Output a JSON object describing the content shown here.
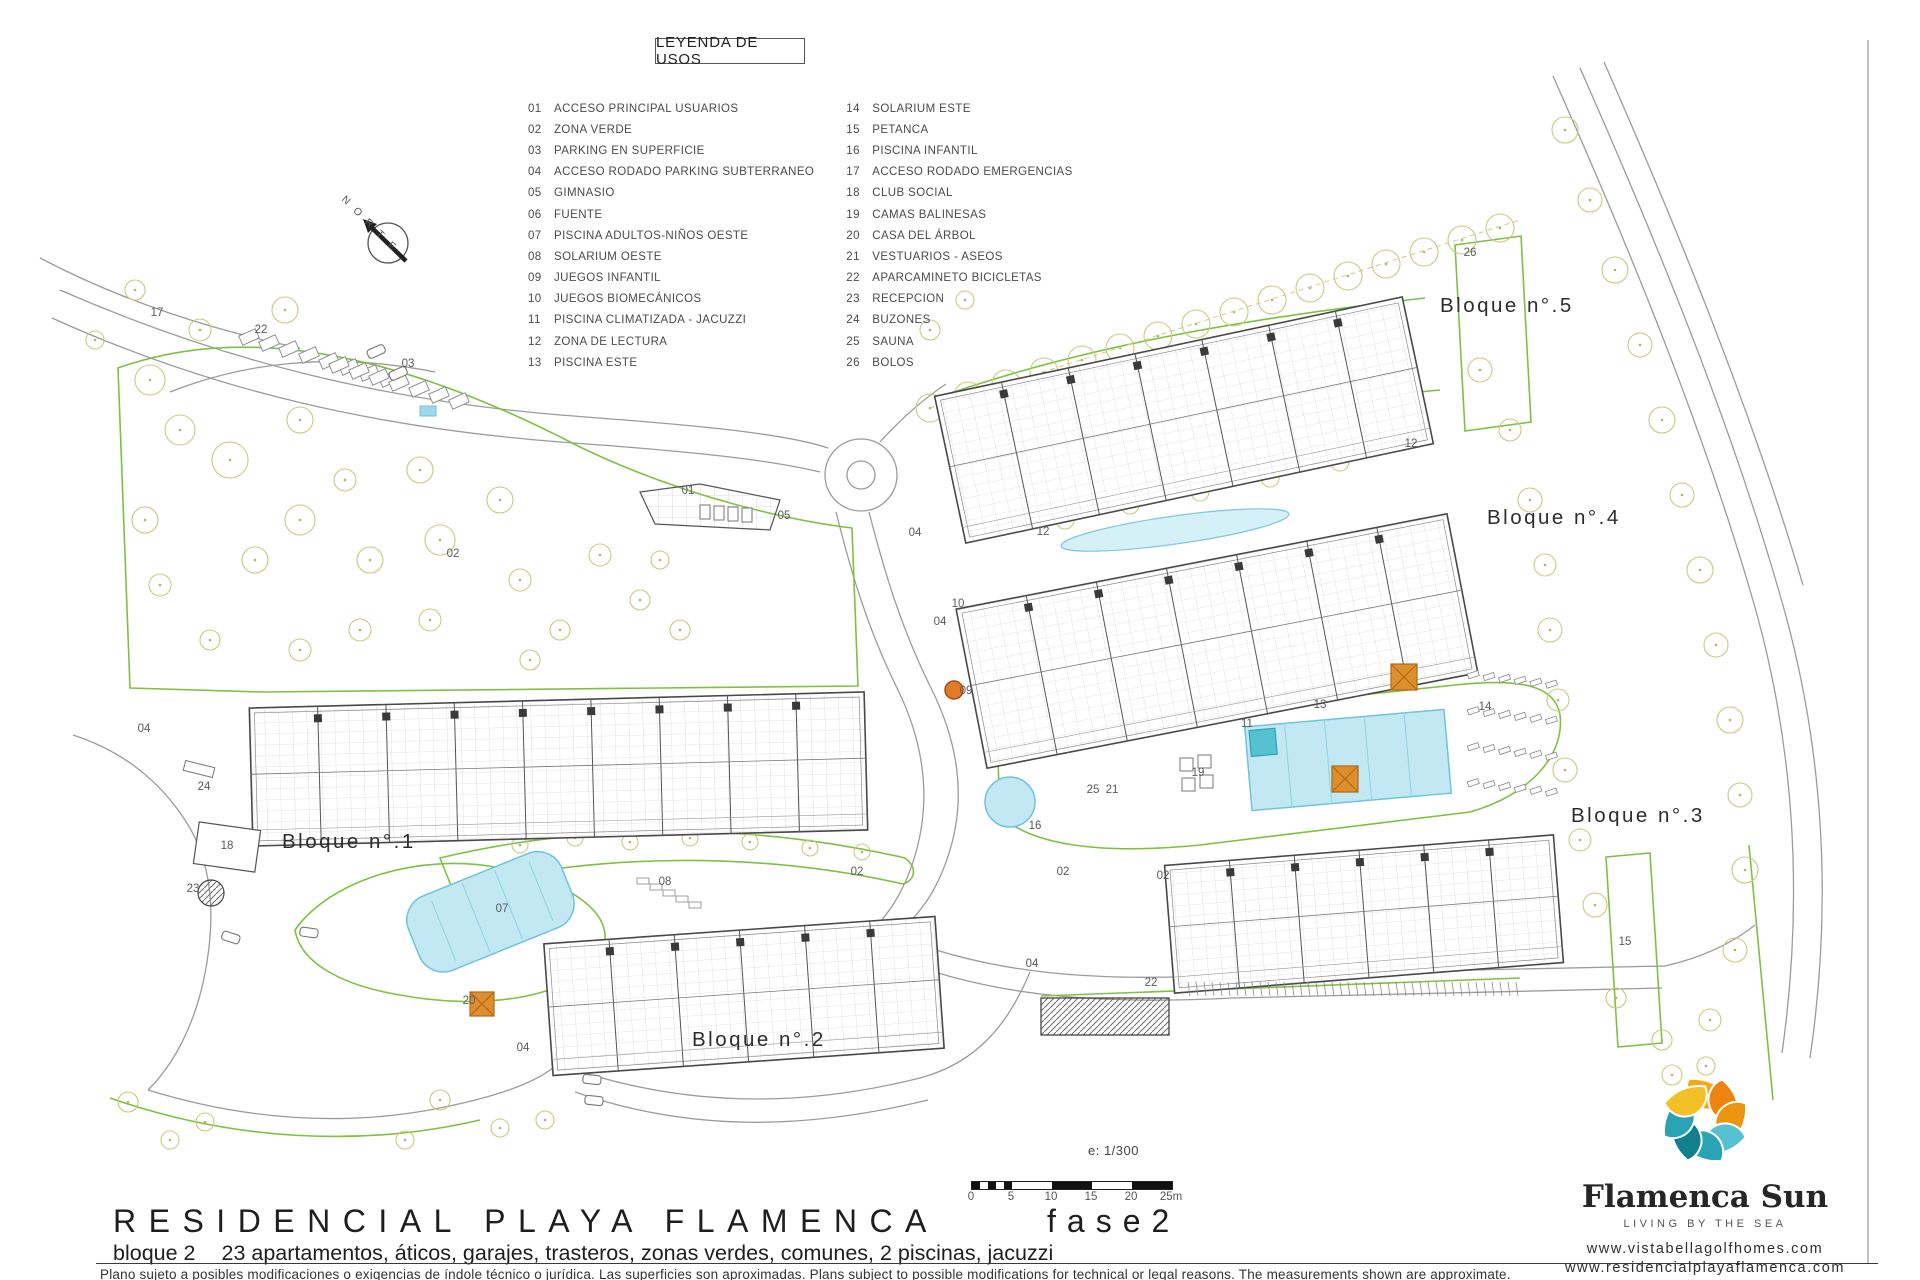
{
  "legend": {
    "title": "LEYENDA DE USOS",
    "col1": [
      {
        "n": "01",
        "t": "ACCESO PRINCIPAL USUARIOS"
      },
      {
        "n": "02",
        "t": "ZONA VERDE"
      },
      {
        "n": "03",
        "t": "PARKING EN SUPERFICIE"
      },
      {
        "n": "04",
        "t": "ACCESO RODADO PARKING SUBTERRANEO"
      },
      {
        "n": "05",
        "t": "GIMNASIO"
      },
      {
        "n": "06",
        "t": "FUENTE"
      },
      {
        "n": "07",
        "t": "PISCINA ADULTOS-NIÑOS OESTE"
      },
      {
        "n": "08",
        "t": "SOLARIUM OESTE"
      },
      {
        "n": "09",
        "t": "JUEGOS INFANTIL"
      },
      {
        "n": "10",
        "t": "JUEGOS BIOMECÁNICOS"
      },
      {
        "n": "11",
        "t": "PISCINA CLIMATIZADA - JACUZZI"
      },
      {
        "n": "12",
        "t": "ZONA DE LECTURA"
      },
      {
        "n": "13",
        "t": "PISCINA ESTE"
      }
    ],
    "col2": [
      {
        "n": "14",
        "t": "SOLARIUM ESTE"
      },
      {
        "n": "15",
        "t": "PETANCA"
      },
      {
        "n": "16",
        "t": "PISCINA INFANTIL"
      },
      {
        "n": "17",
        "t": "ACCESO RODADO EMERGENCIAS"
      },
      {
        "n": "18",
        "t": "CLUB SOCIAL"
      },
      {
        "n": "19",
        "t": "CAMAS BALINESAS"
      },
      {
        "n": "20",
        "t": "CASA DEL ÁRBOL"
      },
      {
        "n": "21",
        "t": "VESTUARIOS - ASEOS"
      },
      {
        "n": "22",
        "t": "APARCAMINETO BICICLETAS"
      },
      {
        "n": "23",
        "t": "RECEPCION"
      },
      {
        "n": "24",
        "t": "BUZONES"
      },
      {
        "n": "25",
        "t": "SAUNA"
      },
      {
        "n": "26",
        "t": "BOLOS"
      }
    ]
  },
  "compass": {
    "label": "NORTE"
  },
  "blocks": [
    {
      "label": "Bloque n°.1",
      "x": 282,
      "y": 848
    },
    {
      "label": "Bloque n°.2",
      "x": 692,
      "y": 1046
    },
    {
      "label": "Bloque n°.3",
      "x": 1571,
      "y": 822
    },
    {
      "label": "Bloque n°.4",
      "x": 1487,
      "y": 524
    },
    {
      "label": "Bloque n°.5",
      "x": 1440,
      "y": 312
    }
  ],
  "plan_labels": [
    {
      "t": "17",
      "x": 157,
      "y": 316
    },
    {
      "t": "22",
      "x": 261,
      "y": 333
    },
    {
      "t": "03",
      "x": 408,
      "y": 367
    },
    {
      "t": "02",
      "x": 453,
      "y": 557
    },
    {
      "t": "01",
      "x": 688,
      "y": 494
    },
    {
      "t": "05",
      "x": 784,
      "y": 519
    },
    {
      "t": "04",
      "x": 915,
      "y": 536
    },
    {
      "t": "04",
      "x": 144,
      "y": 732
    },
    {
      "t": "24",
      "x": 204,
      "y": 790
    },
    {
      "t": "18",
      "x": 227,
      "y": 849
    },
    {
      "t": "23",
      "x": 193,
      "y": 892
    },
    {
      "t": "20",
      "x": 469,
      "y": 1004
    },
    {
      "t": "04",
      "x": 523,
      "y": 1051
    },
    {
      "t": "08",
      "x": 665,
      "y": 885
    },
    {
      "t": "07",
      "x": 502,
      "y": 912
    },
    {
      "t": "02",
      "x": 857,
      "y": 875
    },
    {
      "t": "02",
      "x": 1063,
      "y": 875
    },
    {
      "t": "02",
      "x": 1163,
      "y": 879
    },
    {
      "t": "04",
      "x": 1032,
      "y": 967
    },
    {
      "t": "22",
      "x": 1151,
      "y": 986
    },
    {
      "t": "09",
      "x": 966,
      "y": 694
    },
    {
      "t": "10",
      "x": 958,
      "y": 607
    },
    {
      "t": "04",
      "x": 940,
      "y": 625
    },
    {
      "t": "12",
      "x": 1043,
      "y": 535
    },
    {
      "t": "12",
      "x": 1411,
      "y": 447
    },
    {
      "t": "13",
      "x": 1320,
      "y": 708
    },
    {
      "t": "11",
      "x": 1247,
      "y": 727
    },
    {
      "t": "19",
      "x": 1198,
      "y": 776
    },
    {
      "t": "25",
      "x": 1093,
      "y": 793
    },
    {
      "t": "21",
      "x": 1112,
      "y": 793
    },
    {
      "t": "16",
      "x": 1035,
      "y": 829
    },
    {
      "t": "14",
      "x": 1485,
      "y": 710
    },
    {
      "t": "15",
      "x": 1625,
      "y": 945
    },
    {
      "t": "26",
      "x": 1470,
      "y": 256
    }
  ],
  "scale": {
    "ratio": "e: 1/300",
    "ticks": [
      "0",
      "5",
      "10",
      "15",
      "20",
      "25m"
    ]
  },
  "title_block": {
    "title": "RESIDENCIAL PLAYA FLAMENCA",
    "phase": "fase2",
    "subtitle_lead": "bloque 2",
    "subtitle_rest": "23 apartamentos, áticos, garajes, trasteros, zonas verdes, comunes, 2 piscinas, jacuzzi",
    "disclaimer": "Plano sujeto a posibles modificaciones o exigencias de índole técnico o jurídica.  Las superficies son aproximadas.  Plans subject to possible modifications for technical or legal reasons.  The measurements shown are approximate."
  },
  "logo": {
    "name": "Flamenca Sun",
    "tagline": "LIVING BY THE SEA",
    "url1": "www.vistabellagolfhomes.com",
    "url2": "www.residencialplayaflamenca.com",
    "colors": {
      "yellow": "#f2c128",
      "amber": "#f5a81c",
      "orange": "#ee8410",
      "orange2": "#e9950f",
      "teal_light": "#55c1d1",
      "teal": "#2aa4b5",
      "teal_dark": "#117f8e"
    }
  },
  "colors": {
    "road": "#9b9b9b",
    "building": "#474747",
    "grid": "#bcbcbc",
    "green": "#7ec142",
    "tree": "#ccc87f",
    "tree_dot": "#b5b06a",
    "pool": "#c2e8f3",
    "pool_stroke": "#6fc3da",
    "orange": "#dd8f2e",
    "label": "#5a5a5a"
  }
}
